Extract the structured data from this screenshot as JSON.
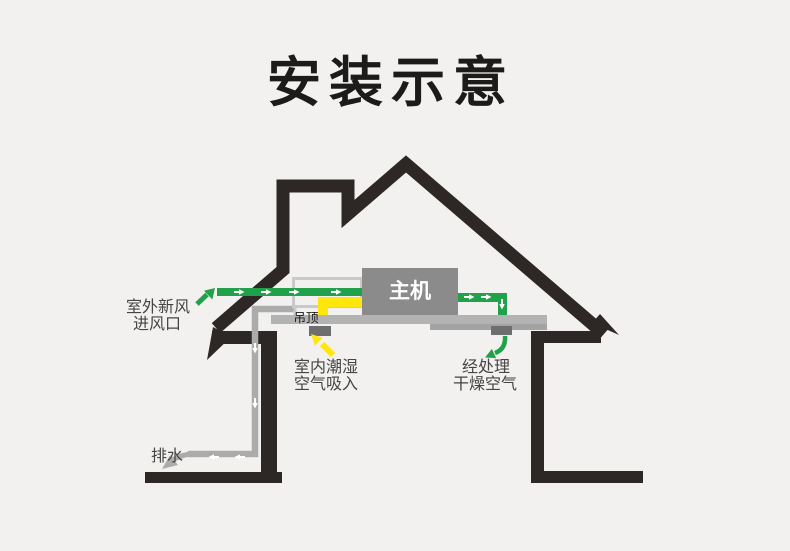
{
  "title": "安装示意",
  "unit": {
    "label": "主机"
  },
  "ceiling": {
    "label": "吊顶"
  },
  "labels": {
    "outdoor_fresh_air": {
      "line1": "室外新风",
      "line2": "进风口"
    },
    "indoor_humid_air": {
      "line1": "室内潮湿",
      "line2": "空气吸入"
    },
    "processed_dry_air": {
      "line1": "经处理",
      "line2": "干燥空气"
    },
    "drain": {
      "text": "排水"
    }
  },
  "colors": {
    "background": "#f2f1ef",
    "structure_black": "#2d2825",
    "ceiling_gray": "#b3b3b3",
    "ceiling_shade_gray": "#a3a3a3",
    "vent_gray": "#6e6e6e",
    "unit_gray": "#8b8b8b",
    "duct_casing_gray": "#c9c9c9",
    "drain_pipe_gray": "#ababab",
    "fresh_air_green": "#22a14b",
    "return_air_yellow": "#ffe70d",
    "title_text": "#1d1b1a",
    "label_text": "#474443",
    "unit_label_text": "#ffffff",
    "flow_mark_white": "#ffffff"
  }
}
